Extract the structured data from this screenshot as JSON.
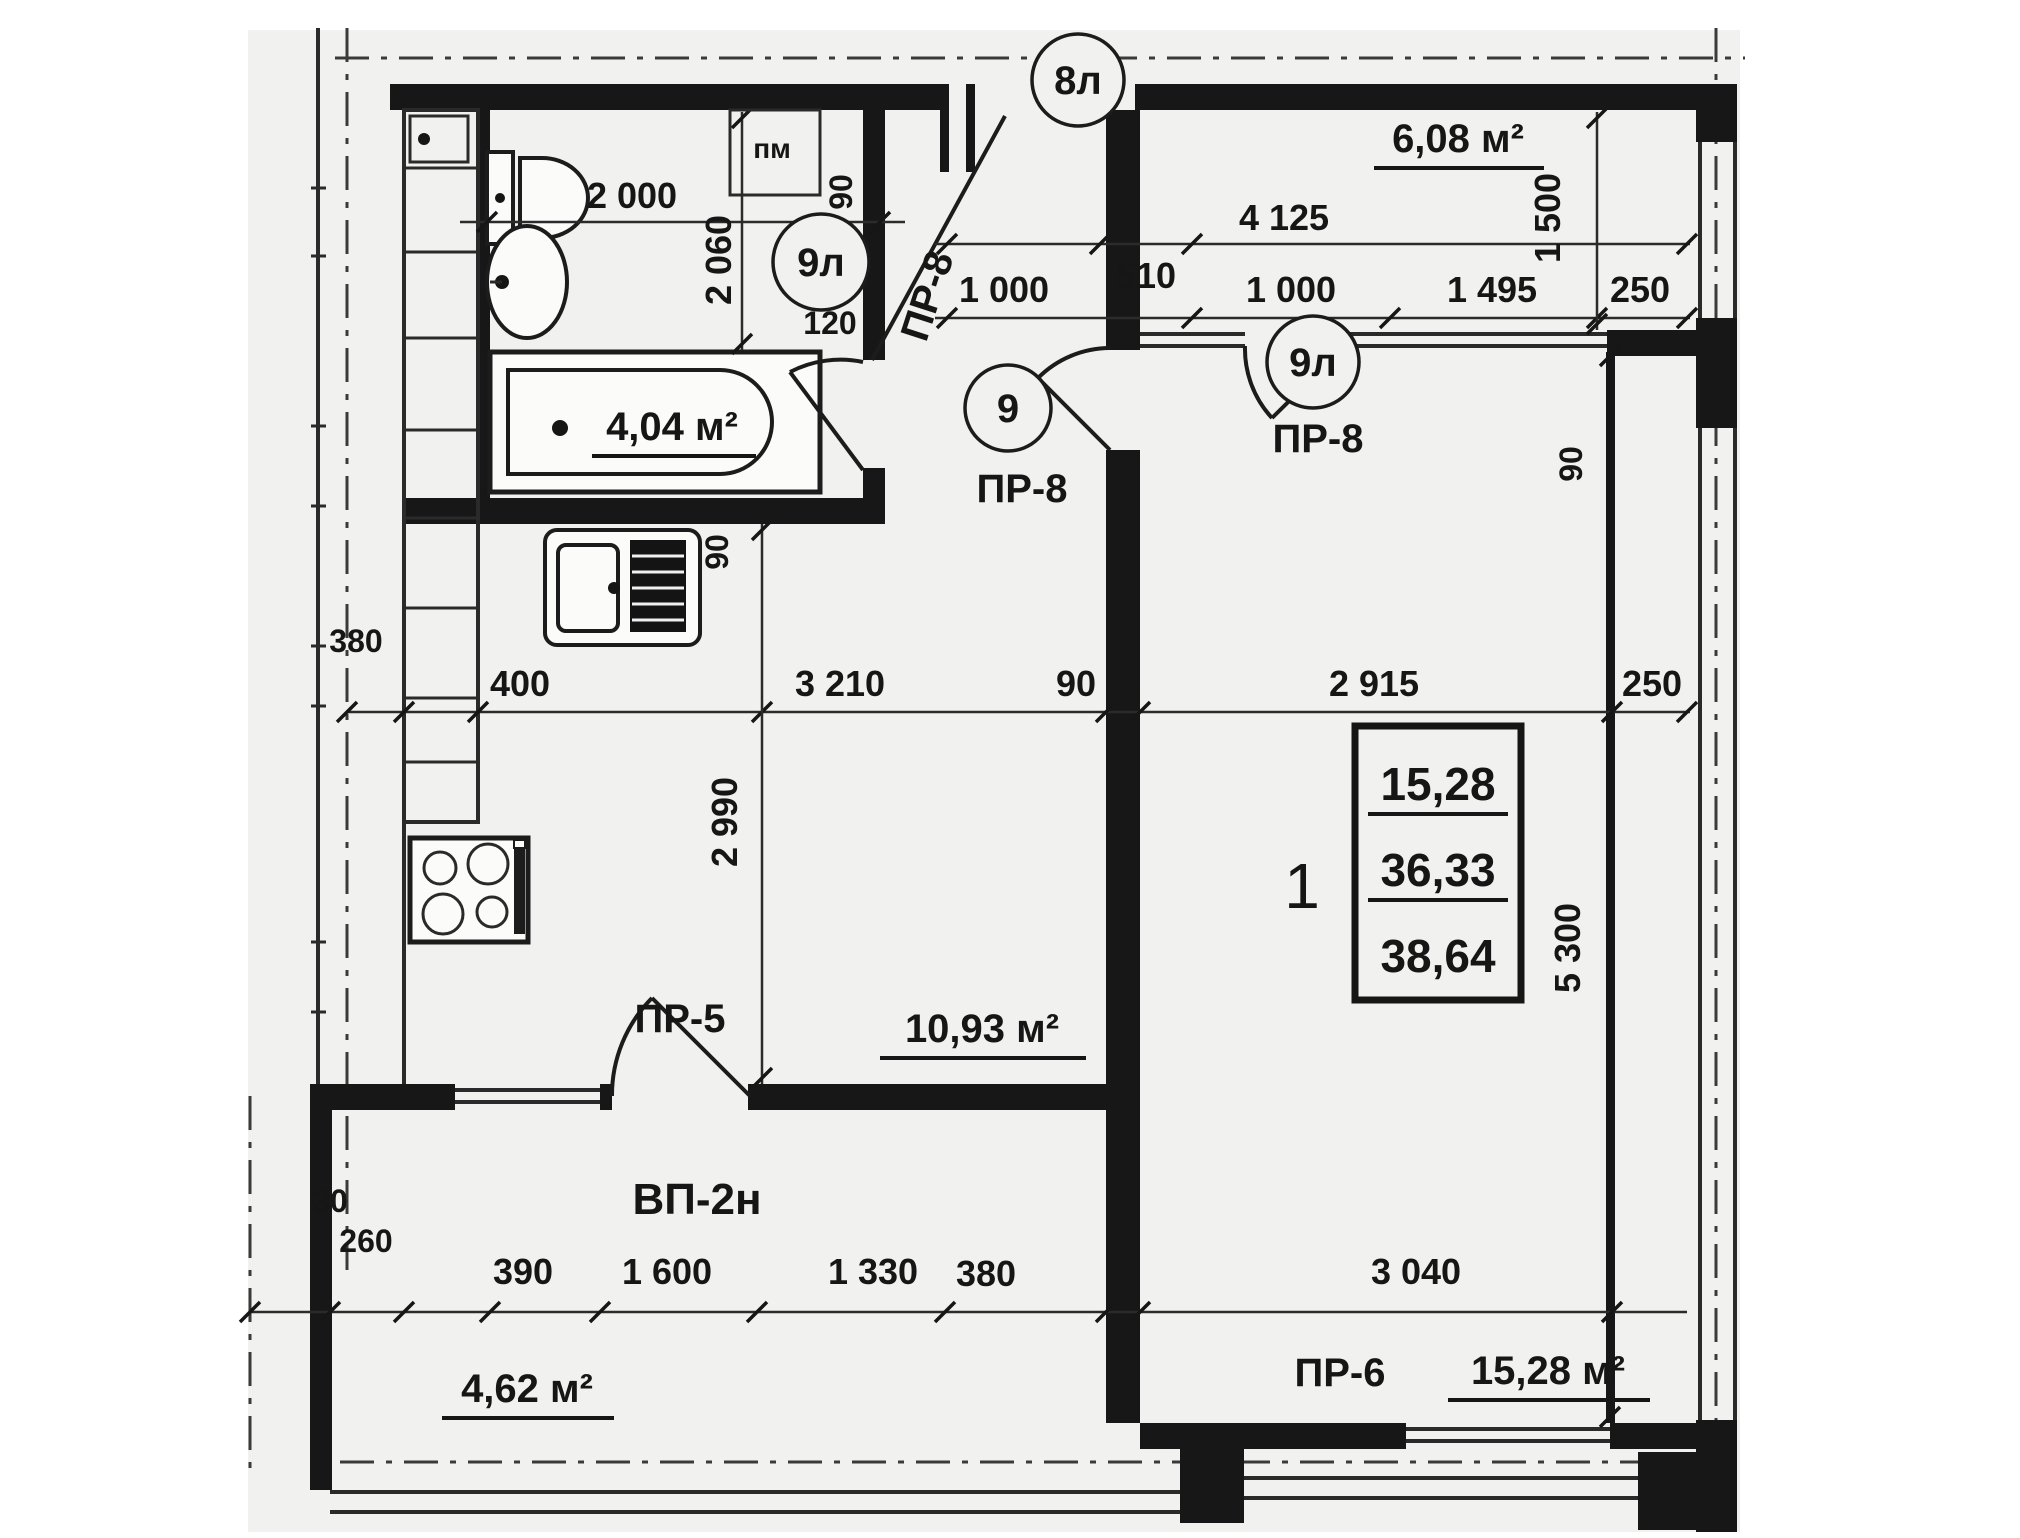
{
  "markers": {
    "top": "8л",
    "bath": "9л",
    "hall": "9",
    "room": "9л"
  },
  "areas": {
    "loggia": "6,08 м²",
    "bath": "4,04 м²",
    "kitchen": "10,93 м²",
    "room": "15,28 м²",
    "balcony": "4,62 м²"
  },
  "doors": {
    "entry": "ПР-8",
    "hall": "ПР-8",
    "room": "ПР-8",
    "kitchen": "ПР-5",
    "room_bottom": "ПР-6",
    "balcony_unit": "ВП-2н"
  },
  "apartment": {
    "number": "1",
    "living": "15,28",
    "heated": "36,33",
    "total": "38,64"
  },
  "labels": {
    "vent": "пм"
  },
  "dims": {
    "bath_w": "2 000",
    "bath_h": "2 060",
    "entry_90": "90",
    "jamb_120": "120",
    "loggia_510": "510",
    "loggia_w": "4 125",
    "hall_1000": "1 000",
    "loggia_1000": "1 000",
    "loggia_1495": "1 495",
    "loggia_250": "250",
    "loggia_d": "1 500",
    "wall_90": "90",
    "mid_400": "400",
    "mid_3210": "3 210",
    "mid_90": "90",
    "mid_2915": "2 915",
    "mid_250": "250",
    "cab_380": "380",
    "sink_90": "90",
    "kitchen_h": "2 990",
    "room_h": "5 300",
    "bot_390": "390",
    "bot_1600": "1 600",
    "bot_1330": "1 330",
    "bot_380": "380",
    "bot_3040": "3 040",
    "balc_30": "30",
    "balc_260": "260"
  }
}
